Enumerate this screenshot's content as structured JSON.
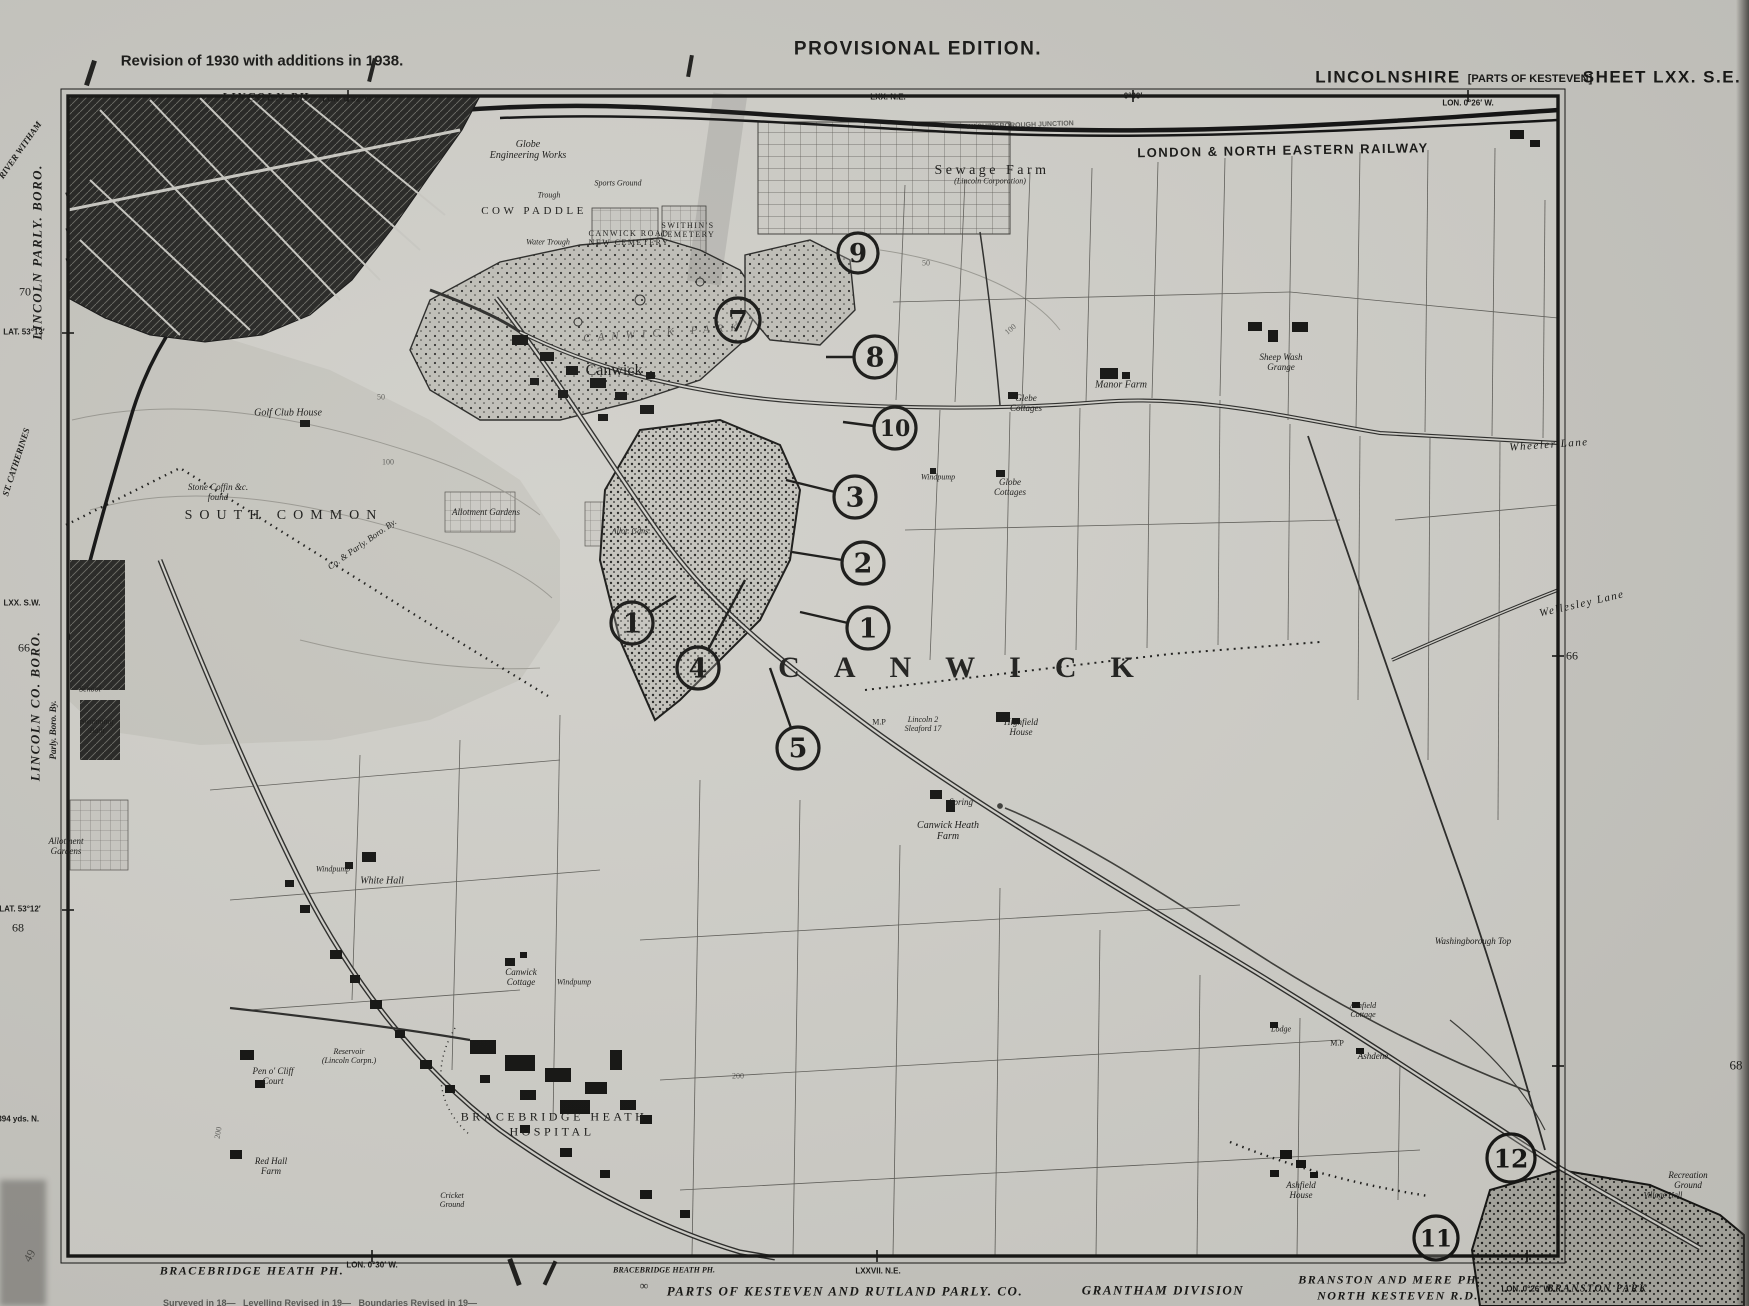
{
  "title_block": {
    "revision_note": "Revision of 1930 with additions in 1938.",
    "edition": "PROVISIONAL EDITION.",
    "county": "LINCOLNSHIRE",
    "county_sub": "[PARTS OF KESTEVEN]",
    "sheet": "SHEET LXX. S.E."
  },
  "colors": {
    "paper": "#c8c7c1",
    "map_bg": "#d0cfc9",
    "ink": "#161614",
    "common_wash": "#c6c5be",
    "wood_fill": "#bfbeb7",
    "urban_fill": "#21211f"
  },
  "labels": [
    {
      "t": "Revision of 1930 with additions in 1938.",
      "x": 262,
      "y": 62,
      "c": "sans b t15"
    },
    {
      "t": "PROVISIONAL EDITION.",
      "x": 918,
      "y": 49,
      "c": "sans b t19 sp1"
    },
    {
      "t": "LINCOLNSHIRE",
      "x": 1388,
      "y": 77,
      "c": "sans b t17 sp1"
    },
    {
      "t": "[PARTS OF KESTEVEN]",
      "x": 1530,
      "y": 79,
      "c": "sans b t11"
    },
    {
      "t": "SHEET LXX. S.E.",
      "x": 1662,
      "y": 77,
      "c": "sans b t17 sp1"
    },
    {
      "t": "LINCOLN PH.",
      "x": 268,
      "y": 97,
      "c": "bi t12 sp1"
    },
    {
      "t": "LON. 0°32′ W.",
      "x": 348,
      "y": 100,
      "c": "sans b t8"
    },
    {
      "t": "LXX. N.E.",
      "x": 888,
      "y": 98,
      "c": "sans b t8"
    },
    {
      "t": "0°30′",
      "x": 1133,
      "y": 97,
      "c": "sans b t8"
    },
    {
      "t": "LON. 0°26′ W.",
      "x": 1468,
      "y": 104,
      "c": "sans b t8"
    },
    {
      "t": "RIVER WITHAM",
      "x": 20,
      "y": 150,
      "c": "bi t9",
      "r": -55
    },
    {
      "t": "LINCOLN PARLY. BORO.",
      "x": 38,
      "y": 252,
      "c": "bi t13 sp1",
      "r": -90
    },
    {
      "t": "70",
      "x": 25,
      "y": 292,
      "c": "t12"
    },
    {
      "t": "LAT. 53°13′",
      "x": 24,
      "y": 333,
      "c": "sans b t8"
    },
    {
      "t": "ST. CATHERINES",
      "x": 16,
      "y": 462,
      "c": "bi t9",
      "r": -72
    },
    {
      "t": "LXX. S.W.",
      "x": 22,
      "y": 604,
      "c": "sans b t8"
    },
    {
      "t": "66",
      "x": 24,
      "y": 648,
      "c": "t12"
    },
    {
      "t": "LINCOLN CO. BORO.",
      "x": 36,
      "y": 706,
      "c": "bi t13 sp1",
      "r": -90
    },
    {
      "t": "Parly. Boro. By.",
      "x": 53,
      "y": 730,
      "c": "bi t9",
      "r": -90
    },
    {
      "t": "LAT. 53°12′",
      "x": 20,
      "y": 910,
      "c": "sans b t8"
    },
    {
      "t": "68",
      "x": 18,
      "y": 928,
      "c": "t12"
    },
    {
      "t": "7394 yds. N.",
      "x": 16,
      "y": 1120,
      "c": "sans b t8"
    },
    {
      "t": "49",
      "x": 30,
      "y": 1256,
      "c": "t12 faded",
      "r": -60
    },
    {
      "t": "66",
      "x": 1572,
      "y": 656,
      "c": "t12"
    },
    {
      "t": "68",
      "x": 1736,
      "y": 1066,
      "c": "t13"
    },
    {
      "t": "BRACEBRIDGE HEATH PH.",
      "x": 252,
      "y": 1271,
      "c": "bi t12 sp1"
    },
    {
      "t": "LON. 0°30′ W.",
      "x": 372,
      "y": 1266,
      "c": "sans b t8"
    },
    {
      "t": "∞",
      "x": 644,
      "y": 1286,
      "c": "t12"
    },
    {
      "t": "BRACEBRIDGE HEATH PH.",
      "x": 664,
      "y": 1271,
      "c": "bi t8"
    },
    {
      "t": "LXXVII. N.E.",
      "x": 878,
      "y": 1272,
      "c": "sans b t8"
    },
    {
      "t": "PARTS OF KESTEVEN AND RUTLAND PARLY. CO.",
      "x": 845,
      "y": 1292,
      "c": "bi t13 sp1"
    },
    {
      "t": "GRANTHAM DIVISION",
      "x": 1163,
      "y": 1291,
      "c": "bi t13 sp1"
    },
    {
      "t": "BRANSTON AND MERE PH.",
      "x": 1390,
      "y": 1280,
      "c": "bi t12 sp1"
    },
    {
      "t": "NORTH KESTEVEN R.D.",
      "x": 1398,
      "y": 1296,
      "c": "bi t12 sp1"
    },
    {
      "t": "LON. 0°26′ W.",
      "x": 1527,
      "y": 1290,
      "c": "sans b t8"
    },
    {
      "t": "BRANSTON PARK",
      "x": 1597,
      "y": 1289,
      "c": "bi t10 sp1"
    },
    {
      "t": "Surveyed in 18—   Levelling Revised in 19—   Boundaries Revised in 19—",
      "x": 320,
      "y": 1303,
      "c": "sans b t9 faded"
    },
    {
      "t": "Globe|Engineering Works",
      "x": 528,
      "y": 150,
      "c": "i t10"
    },
    {
      "t": "Sports Ground",
      "x": 618,
      "y": 184,
      "c": "i t8"
    },
    {
      "t": "Trough",
      "x": 549,
      "y": 196,
      "c": "i t8"
    },
    {
      "t": "COW PADDLE",
      "x": 534,
      "y": 211,
      "c": "t11 sp2"
    },
    {
      "t": "Water Trough",
      "x": 548,
      "y": 243,
      "c": "i t8"
    },
    {
      "t": "CANWICK ROAD|NEW CEMETERY",
      "x": 629,
      "y": 239,
      "c": "t8 sp1"
    },
    {
      "t": "SWITHIN'S|CEMETERY",
      "x": 688,
      "y": 231,
      "c": "t8 sp1"
    },
    {
      "t": "Sewage Farm",
      "x": 992,
      "y": 171,
      "c": "t14 sp2"
    },
    {
      "t": "(Lincoln Corporation)",
      "x": 990,
      "y": 182,
      "c": "i t8"
    },
    {
      "t": "WASHINGBOROUGH JUNCTION",
      "x": 1020,
      "y": 126,
      "c": "sans b t7 faded",
      "r": -2
    },
    {
      "t": "LONDON & NORTH EASTERN RAILWAY",
      "x": 1283,
      "y": 151,
      "c": "sans b t13 sp1",
      "r": -1
    },
    {
      "t": "Golf Club House",
      "x": 288,
      "y": 413,
      "c": "i t10"
    },
    {
      "t": "Stone Coffin &c.|found",
      "x": 218,
      "y": 492,
      "c": "i t9"
    },
    {
      "t": "SOUTH COMMON",
      "x": 284,
      "y": 516,
      "c": "t14 sp3"
    },
    {
      "t": "Co. & Parly. Boro. By.",
      "x": 362,
      "y": 544,
      "c": "i t9",
      "r": -35
    },
    {
      "t": "Allotment Gardens",
      "x": 486,
      "y": 512,
      "c": "i t9"
    },
    {
      "t": "Allot. Gdns.",
      "x": 631,
      "y": 532,
      "c": "i t8"
    },
    {
      "t": "School",
      "x": 90,
      "y": 690,
      "c": "i t8"
    },
    {
      "t": "Swimming|Bath",
      "x": 97,
      "y": 727,
      "c": "i t8"
    },
    {
      "t": "Allotment|Gardens",
      "x": 66,
      "y": 846,
      "c": "i t9"
    },
    {
      "t": "CANWICK PARK",
      "x": 664,
      "y": 333,
      "c": "i t11 sp3 faded",
      "r": -4
    },
    {
      "t": "Canwick",
      "x": 614,
      "y": 371,
      "c": "t16"
    },
    {
      "t": "CANWICK",
      "x": 973,
      "y": 668,
      "c": "bigname"
    },
    {
      "t": "M.P",
      "x": 879,
      "y": 723,
      "c": "t8"
    },
    {
      "t": "Lincoln 2|Sleaford 17",
      "x": 923,
      "y": 725,
      "c": "i t8"
    },
    {
      "t": "Highfield|House",
      "x": 1021,
      "y": 727,
      "c": "i t9"
    },
    {
      "t": "Spring",
      "x": 961,
      "y": 802,
      "c": "i t9"
    },
    {
      "t": "Canwick Heath|Farm",
      "x": 948,
      "y": 831,
      "c": "i t10"
    },
    {
      "t": "Windpump",
      "x": 333,
      "y": 870,
      "c": "i t8"
    },
    {
      "t": "White Hall",
      "x": 382,
      "y": 881,
      "c": "i t10"
    },
    {
      "t": "Canwick|Cottage",
      "x": 521,
      "y": 977,
      "c": "i t9"
    },
    {
      "t": "Windpump",
      "x": 574,
      "y": 983,
      "c": "i t8"
    },
    {
      "t": "BRACEBRIDGE HEATH",
      "x": 554,
      "y": 1117,
      "c": "t12 sp2"
    },
    {
      "t": "HOSPITAL",
      "x": 552,
      "y": 1132,
      "c": "t12 sp2"
    },
    {
      "t": "Pen o' Cliff|Court",
      "x": 273,
      "y": 1076,
      "c": "i t9"
    },
    {
      "t": "Reservoir|(Lincoln Corpn.)",
      "x": 349,
      "y": 1057,
      "c": "i t8"
    },
    {
      "t": "Red Hall|Farm",
      "x": 271,
      "y": 1166,
      "c": "i t9"
    },
    {
      "t": "Cricket|Ground",
      "x": 452,
      "y": 1201,
      "c": "i t8"
    },
    {
      "t": "Glebe|Cottages",
      "x": 1026,
      "y": 403,
      "c": "i t9"
    },
    {
      "t": "Manor Farm",
      "x": 1121,
      "y": 385,
      "c": "i t10"
    },
    {
      "t": "Windpump",
      "x": 938,
      "y": 478,
      "c": "i t8"
    },
    {
      "t": "Globe|Cottages",
      "x": 1010,
      "y": 487,
      "c": "i t9"
    },
    {
      "t": "Sheep Wash|Grange",
      "x": 1281,
      "y": 362,
      "c": "i t9"
    },
    {
      "t": "Wheeler Lane",
      "x": 1549,
      "y": 445,
      "c": "i t11 sp1",
      "r": -4
    },
    {
      "t": "Wellesley Lane",
      "x": 1582,
      "y": 604,
      "c": "i t11 sp1",
      "r": -13
    },
    {
      "t": "Washingborough Top",
      "x": 1473,
      "y": 941,
      "c": "i t9"
    },
    {
      "t": "Lodge",
      "x": 1281,
      "y": 1030,
      "c": "i t8"
    },
    {
      "t": "M.P",
      "x": 1337,
      "y": 1044,
      "c": "t8"
    },
    {
      "t": "Ashfield|Cottage",
      "x": 1363,
      "y": 1011,
      "c": "i t8"
    },
    {
      "t": "Ashdene",
      "x": 1373,
      "y": 1056,
      "c": "i t9"
    },
    {
      "t": "Ashfield|House",
      "x": 1301,
      "y": 1190,
      "c": "i t9"
    },
    {
      "t": "Recreation|Ground",
      "x": 1688,
      "y": 1180,
      "c": "i t9"
    },
    {
      "t": "Village Hall",
      "x": 1663,
      "y": 1196,
      "c": "i t8"
    },
    {
      "t": "50",
      "x": 381,
      "y": 398,
      "c": "t8 faded"
    },
    {
      "t": "100",
      "x": 388,
      "y": 463,
      "c": "t8 faded"
    },
    {
      "t": "50",
      "x": 926,
      "y": 264,
      "c": "t8 faded"
    },
    {
      "t": "100",
      "x": 1011,
      "y": 330,
      "c": "t8 faded",
      "r": -40
    },
    {
      "t": "200",
      "x": 219,
      "y": 1133,
      "c": "t8 faded",
      "r": -80
    },
    {
      "t": "200",
      "x": 738,
      "y": 1077,
      "c": "t8 faded"
    }
  ],
  "annotations": {
    "circles": [
      {
        "n": "7",
        "x": 738,
        "y": 320,
        "r": 22,
        "leader": null
      },
      {
        "n": "9",
        "x": 858,
        "y": 253,
        "r": 20,
        "leader": null
      },
      {
        "n": "8",
        "x": 875,
        "y": 357,
        "r": 21,
        "leader": [
          854,
          357,
          826,
          357
        ]
      },
      {
        "n": "10",
        "x": 895,
        "y": 428,
        "r": 21,
        "leader": [
          874,
          426,
          843,
          422
        ]
      },
      {
        "n": "3",
        "x": 855,
        "y": 497,
        "r": 21,
        "leader": [
          835,
          492,
          786,
          480
        ]
      },
      {
        "n": "2",
        "x": 863,
        "y": 563,
        "r": 21,
        "leader": [
          842,
          560,
          792,
          552
        ]
      },
      {
        "n": "1",
        "x": 868,
        "y": 628,
        "r": 21,
        "leader": [
          848,
          623,
          800,
          612
        ]
      },
      {
        "n": "1",
        "x": 632,
        "y": 623,
        "r": 21,
        "leader": [
          650,
          612,
          676,
          596
        ]
      },
      {
        "n": "4",
        "x": 698,
        "y": 668,
        "r": 21,
        "leader": [
          708,
          650,
          745,
          580
        ]
      },
      {
        "n": "5",
        "x": 798,
        "y": 748,
        "r": 21,
        "leader": [
          791,
          728,
          770,
          668
        ]
      },
      {
        "n": "11",
        "x": 1436,
        "y": 1238,
        "r": 22,
        "leader": null
      },
      {
        "n": "12",
        "x": 1511,
        "y": 1158,
        "r": 24,
        "leader": null
      }
    ]
  }
}
